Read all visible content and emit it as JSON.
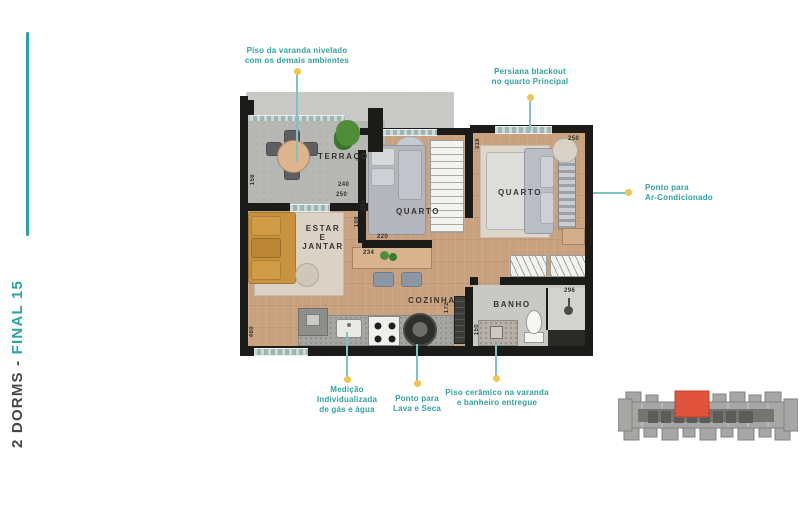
{
  "title": {
    "prefix": "2 DORMS - ",
    "highlight": "FINAL 15"
  },
  "rooms": {
    "terraco": "TERRAÇO",
    "estar": [
      "ESTAR",
      "E",
      "JANTAR"
    ],
    "quarto1": "QUARTO",
    "quarto2": "QUARTO",
    "cozinha": "COZINHA",
    "banho": "BANHO"
  },
  "dims": {
    "t_h": "158",
    "t_w": "240",
    "estar_top": "250",
    "hall": "108",
    "q1_side": "225",
    "q1_w": "220",
    "island": "234",
    "q2_side": "318",
    "q2_w": "250",
    "shower": "296",
    "corridor": "172",
    "banho_door": "150",
    "estar_len": "460"
  },
  "annotations": [
    {
      "id": "piso-varanda",
      "lines": [
        "Piso da varanda nivelado",
        "com os demais ambientes"
      ]
    },
    {
      "id": "persiana",
      "lines": [
        "Persiana blackout",
        "no quarto Principal"
      ]
    },
    {
      "id": "ar-condicionado",
      "lines": [
        "Ponto para",
        "Ar-Condicionado"
      ]
    },
    {
      "id": "medicao",
      "lines": [
        "Medição",
        "Individualizada",
        "de gás e água"
      ]
    },
    {
      "id": "lava-seca",
      "lines": [
        "Ponto para",
        "Lava e Seca"
      ]
    },
    {
      "id": "piso-ceramico",
      "lines": [
        "Piso cerâmico na varanda",
        "e banheiro entregue"
      ]
    }
  ],
  "colors": {
    "teal": "#2aa3a2",
    "leader_line": "#7cc4c2",
    "leader_dot": "#f0c64d",
    "wall": "#1b1b1a",
    "wood_floor": "#c8a17f",
    "terrace_floor": "#b7b7b3",
    "keyplan_gray": "#a6a6a4",
    "keyplan_highlight": "#e2533c"
  }
}
